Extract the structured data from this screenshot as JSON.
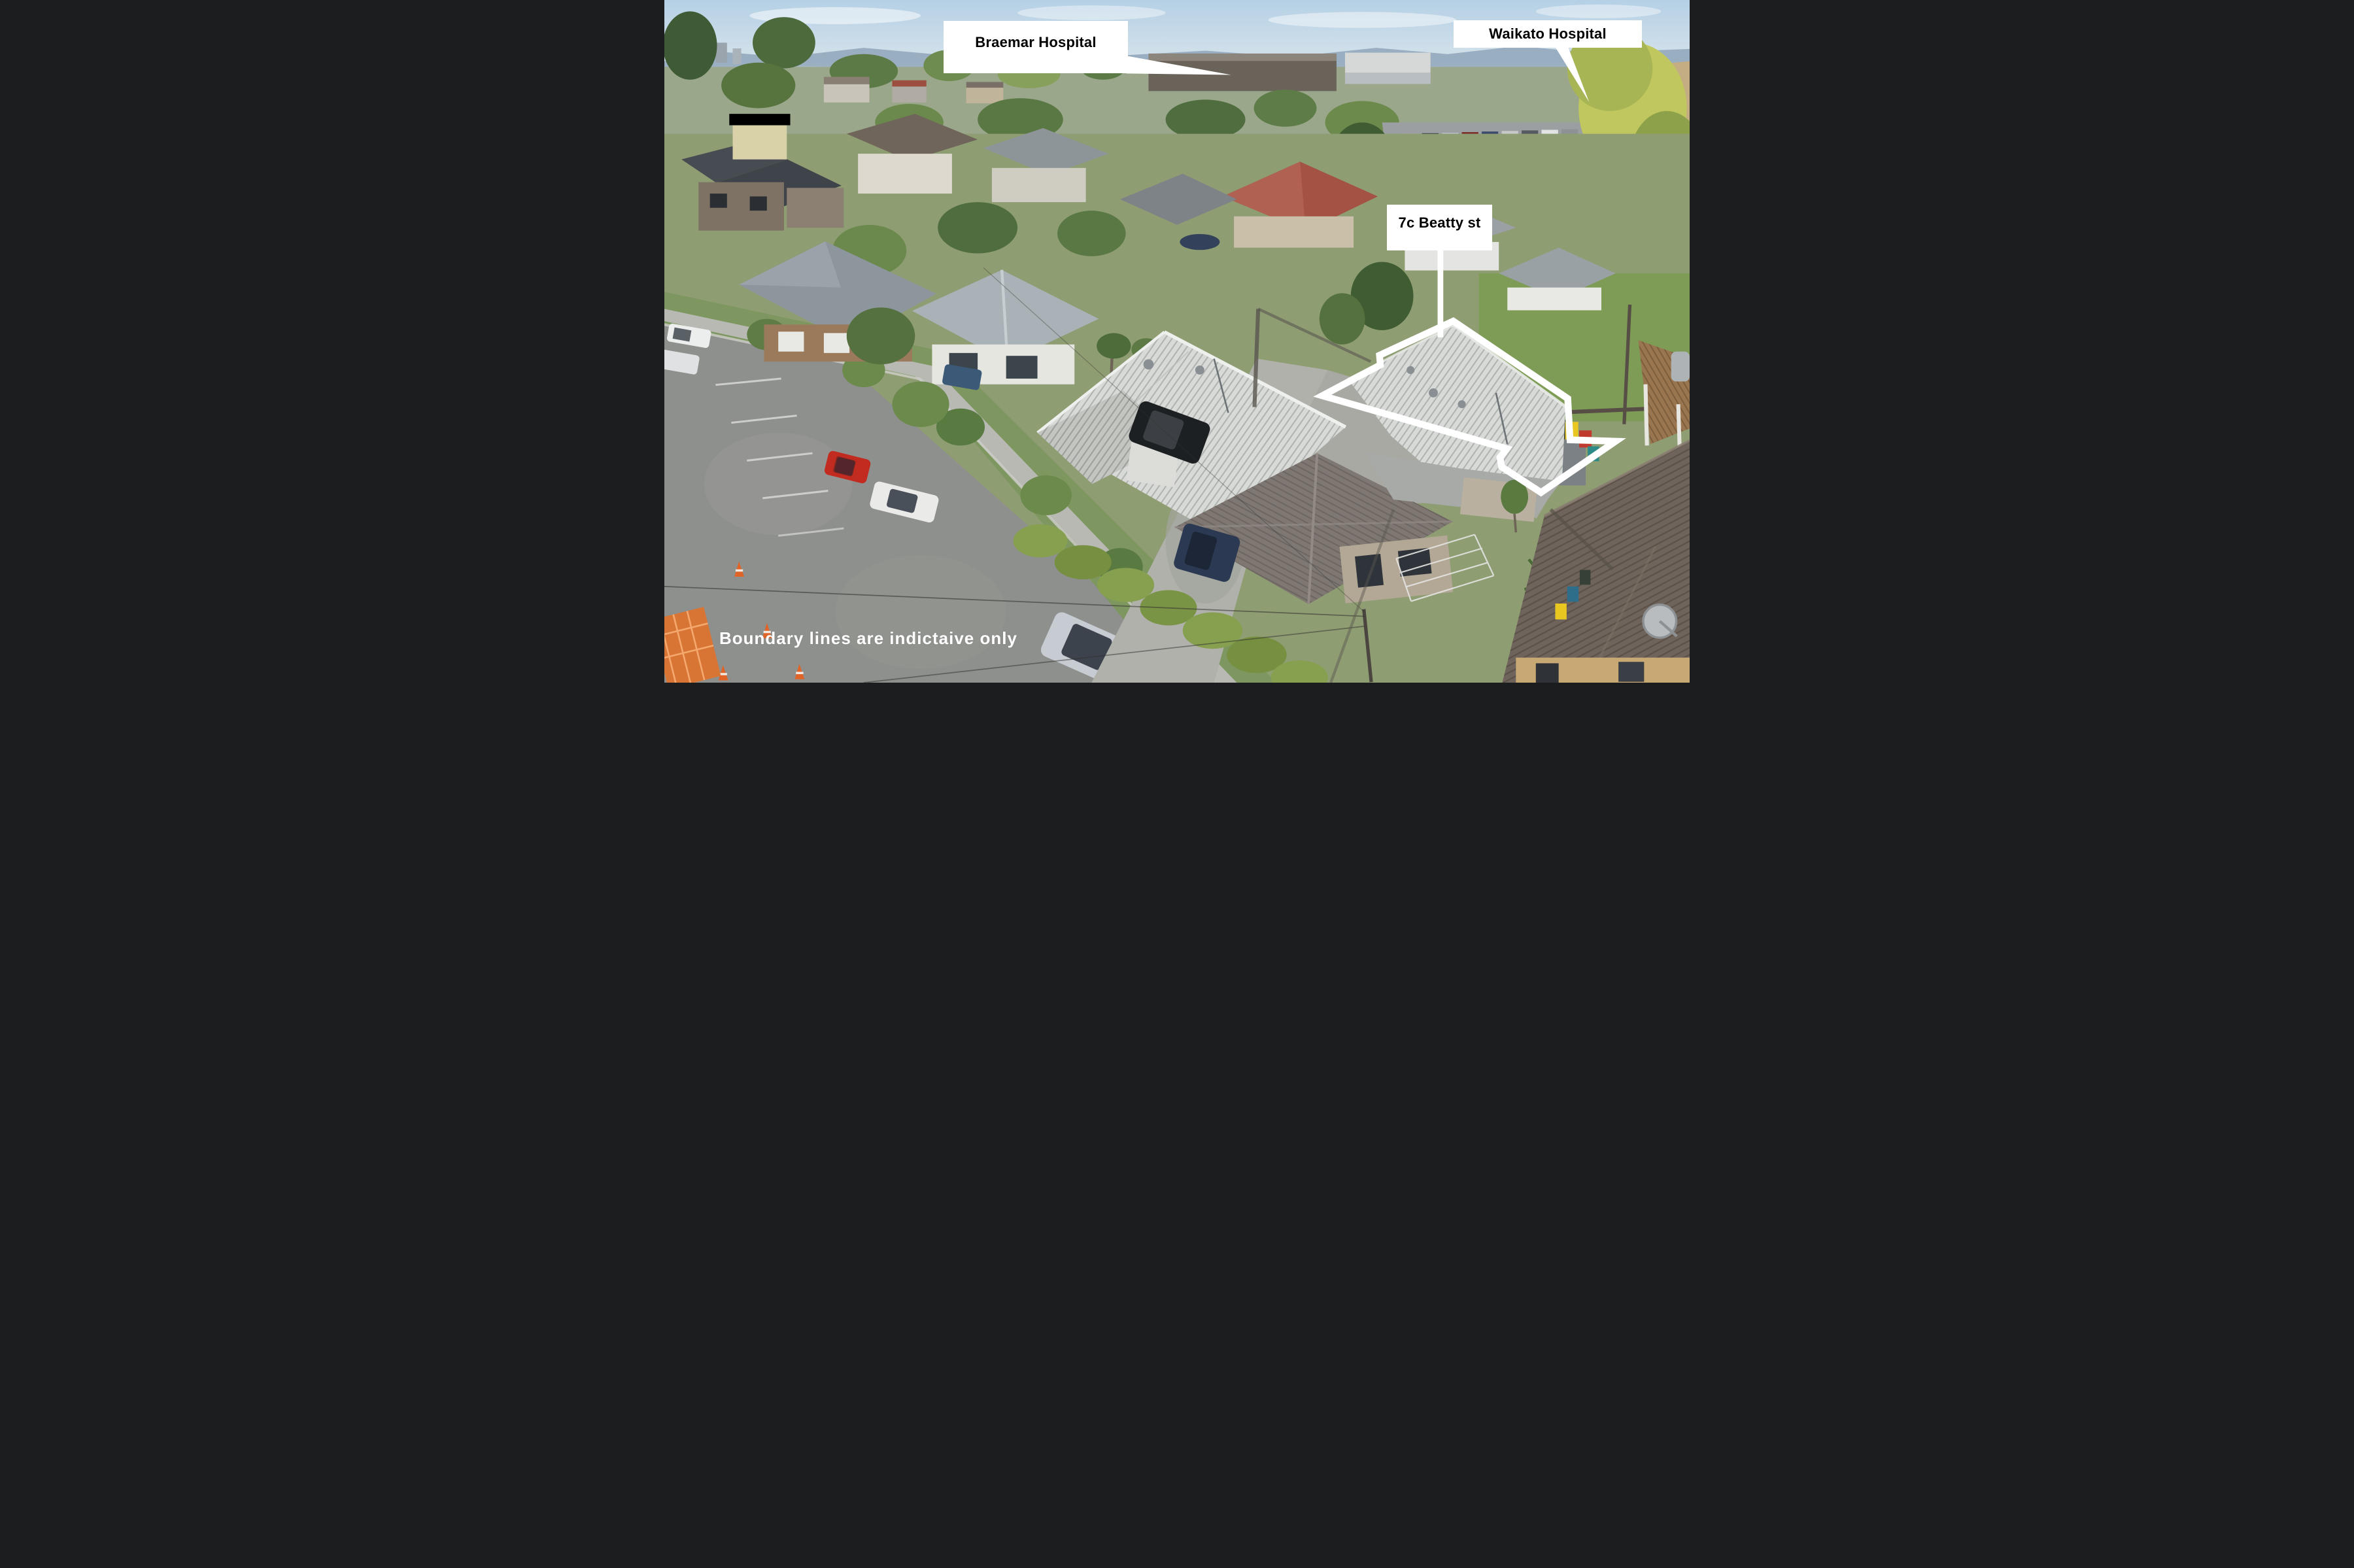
{
  "annotations": {
    "braemar_hospital": {
      "label": "Braemar Hospital"
    },
    "waikato_hospital": {
      "label": "Waikato Hospital"
    },
    "property": {
      "label": "7c Beatty st"
    },
    "disclaimer": {
      "text": "Boundary lines are indictaive only"
    }
  },
  "colors": {
    "boundary_line": "#ffffff",
    "pointer_line": "#ffffff",
    "label_background": "#ffffff",
    "label_text": "#000000",
    "disclaimer_text": "#ffffff"
  }
}
